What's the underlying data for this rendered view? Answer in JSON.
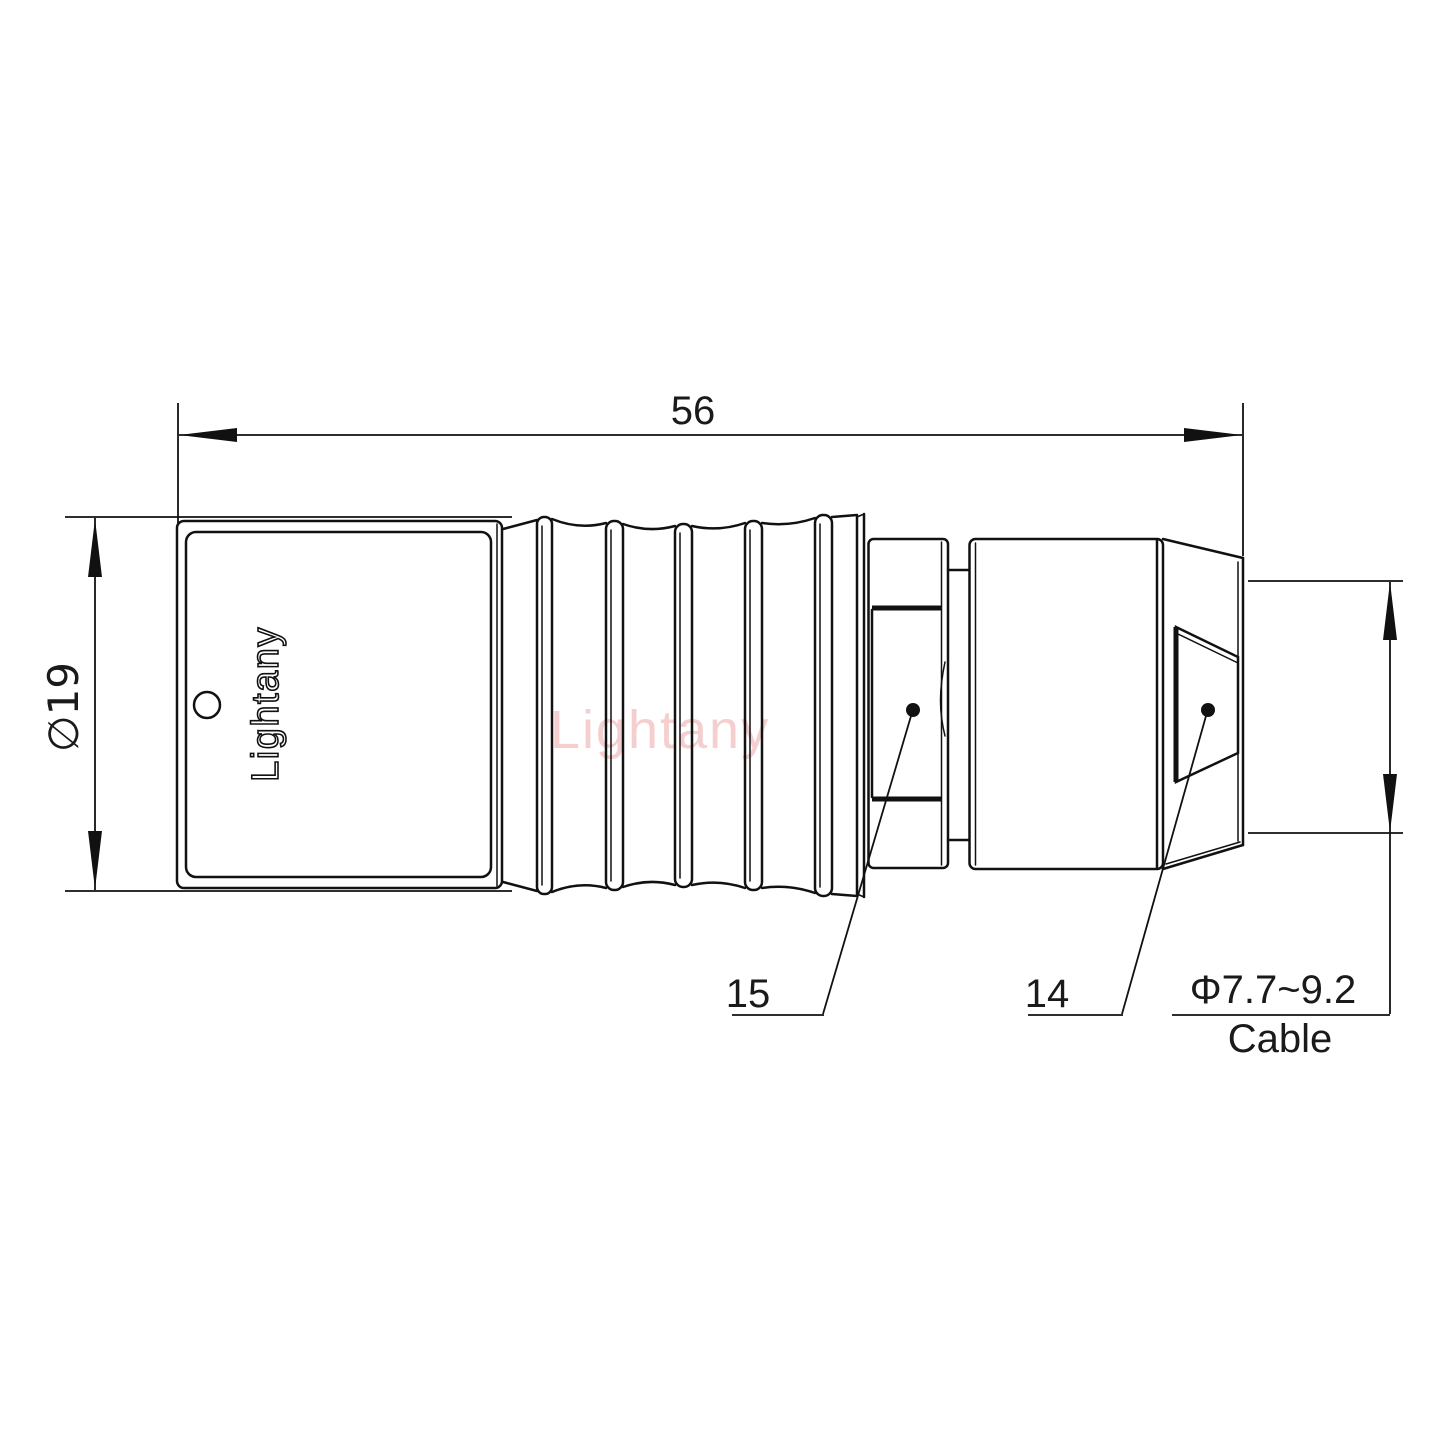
{
  "drawing": {
    "brand_label": "Lightany",
    "watermark": "Lightany",
    "dimensions": {
      "length": "56",
      "diameter": "∅19",
      "cable_range": "Φ7.7~9.2",
      "cable_label": "Cable"
    },
    "parts": {
      "insert_number": "15",
      "backshell_number": "14"
    },
    "colors": {
      "line": "#111111",
      "watermark": "#eda8a8",
      "background": "#ffffff"
    }
  }
}
